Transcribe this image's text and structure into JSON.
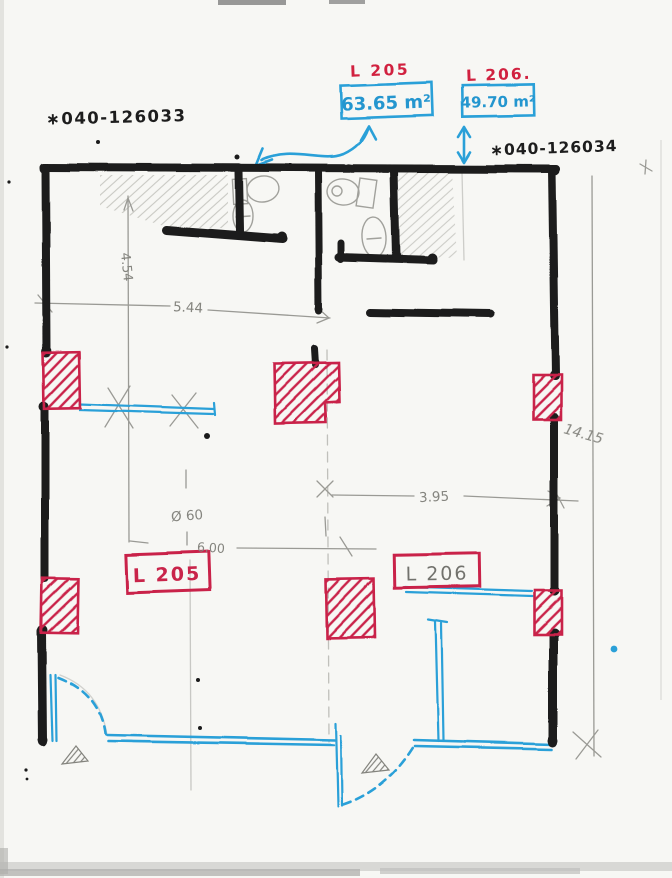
{
  "document": {
    "kind": "hand-drawn floor plan sketch",
    "sheet": "scanned notebook page"
  },
  "palette": {
    "ink": "#1b1b1b",
    "red": "#cc2345",
    "blue": "#2aa0d8",
    "pencil": "#8a8a84"
  },
  "annotations": {
    "parcel_left": "∗040-126033",
    "parcel_right": "∗040-126034"
  },
  "units": {
    "l205": {
      "label": "L 205",
      "area": "63.65 m²",
      "room_tag": "L 205"
    },
    "l206": {
      "label": "L 206.",
      "area": "49.70 m²",
      "room_tag": "L 206"
    }
  },
  "dimensions": {
    "left_height": "4.54",
    "top_width": "5.44",
    "diameter": "Ø 60",
    "width": "6.00",
    "right_width": "3.95",
    "total_height": "14.15"
  }
}
